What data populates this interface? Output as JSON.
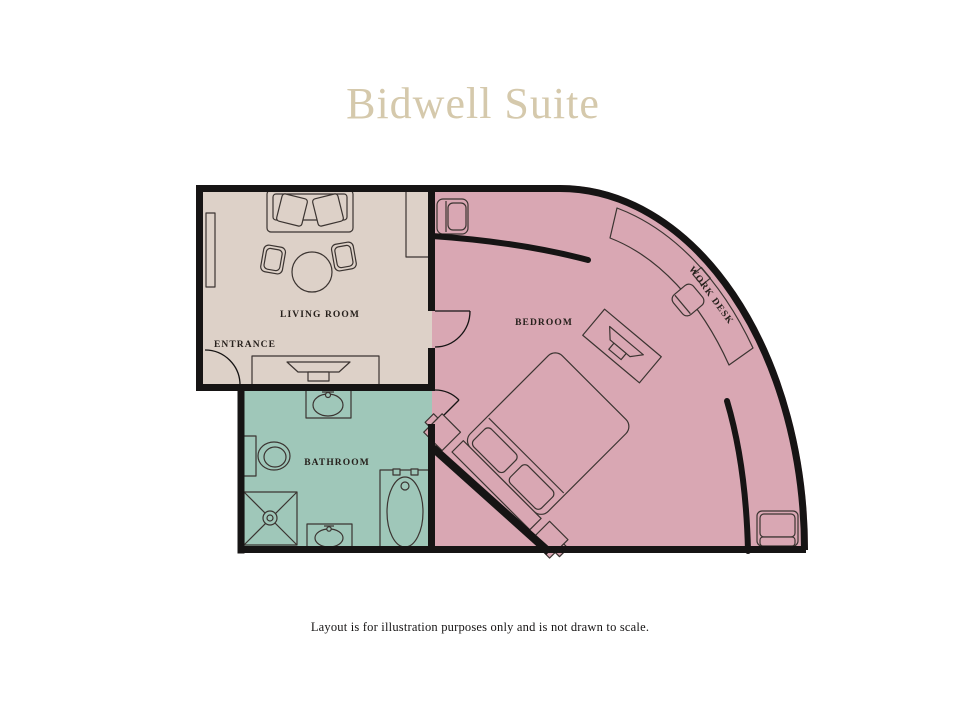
{
  "title": "Bidwell Suite",
  "footer_note": "Layout is for illustration purposes only and is not drawn to scale.",
  "rooms": {
    "living_room": {
      "label": "LIVING ROOM",
      "color": "#ddd1c8"
    },
    "entrance": {
      "label": "ENTRANCE"
    },
    "bathroom": {
      "label": "BATHROOM",
      "color": "#9fc7b9"
    },
    "bedroom": {
      "label": "BEDROOM",
      "color": "#d9a7b3"
    },
    "work_desk": {
      "label": "WORK DESK"
    }
  },
  "colors": {
    "background": "#ffffff",
    "wall": "#161414",
    "furniture_stroke": "#3b3431",
    "label": "#26201c",
    "title": "#d5c9ac",
    "footer": "#161414"
  }
}
